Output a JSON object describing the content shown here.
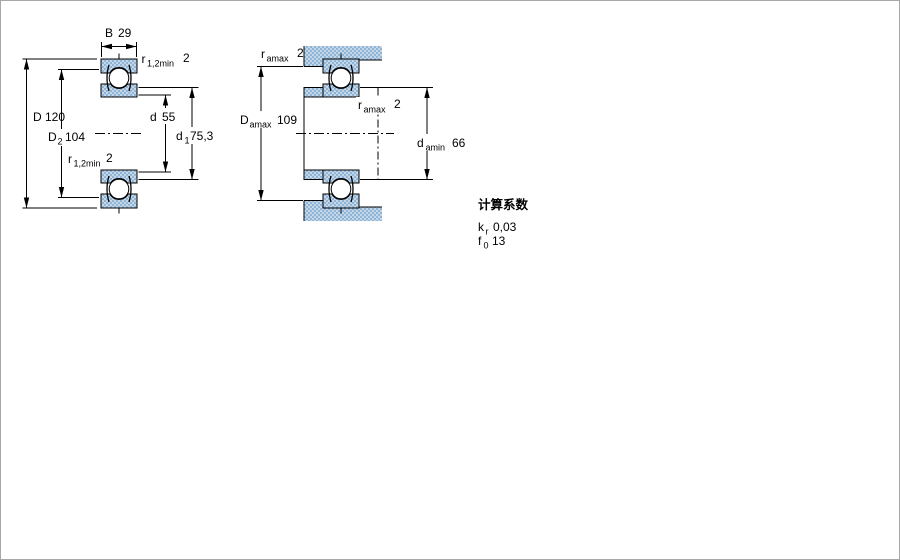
{
  "drawing": {
    "title_hint": "bearing cross-section and abutment dimensions",
    "colors": {
      "stipple_light": "#c3d7e8",
      "stipple_dark": "#8fb4d6",
      "line": "#000000",
      "frame": "#a8a8a8",
      "background": "#ffffff"
    },
    "left_view": {
      "dim_B": {
        "symbol": "B",
        "value": "29"
      },
      "dim_r12_top": {
        "symbol": "r",
        "sub": "1,2min",
        "value": "2"
      },
      "dim_D": {
        "symbol": "D",
        "value": "120"
      },
      "dim_D2": {
        "symbol": "D",
        "sub": "2",
        "value": "104"
      },
      "dim_r12_bot": {
        "symbol": "r",
        "sub": "1,2min",
        "value": "2"
      },
      "dim_d": {
        "symbol": "d",
        "value": "55"
      },
      "dim_d1": {
        "symbol": "d",
        "sub": "1",
        "value": "75,3"
      }
    },
    "right_view": {
      "dim_ra_top": {
        "symbol": "r",
        "sub": "amax",
        "value": "2"
      },
      "dim_Da": {
        "symbol": "D",
        "sub": "amax",
        "value": "109"
      },
      "dim_ra_mid": {
        "symbol": "r",
        "sub": "amax",
        "value": "2"
      },
      "dim_da": {
        "symbol": "d",
        "sub": "amin",
        "value": "66"
      }
    }
  },
  "factors": {
    "title": "计算系数",
    "rows": [
      {
        "symbol": "k",
        "sub": "r",
        "value": "0,03"
      },
      {
        "symbol": "f",
        "sub": "0",
        "value": "13"
      }
    ]
  }
}
